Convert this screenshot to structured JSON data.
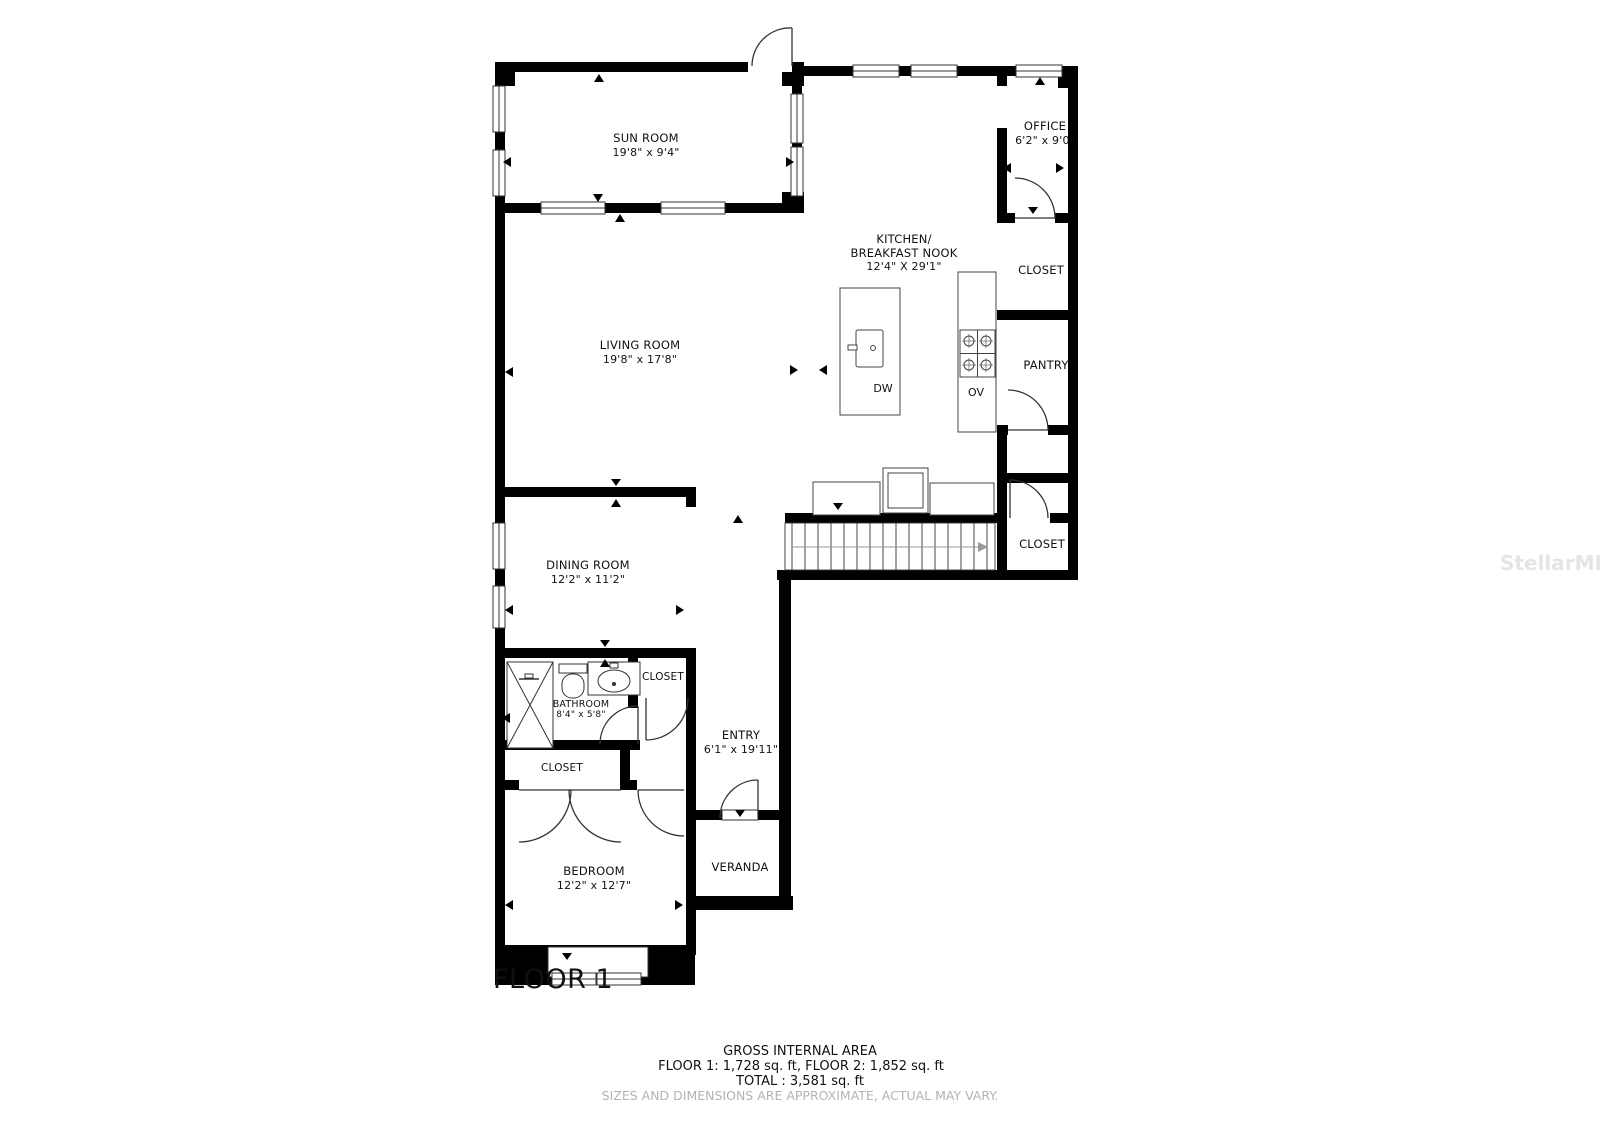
{
  "floorplan": {
    "floor_label": "FLOOR 1",
    "rooms": {
      "sun_room": {
        "name": "SUN ROOM",
        "dims": "19'8\" x 9'4\""
      },
      "office": {
        "name": "OFFICE",
        "dims": "6'2\" x 9'0\""
      },
      "kitchen": {
        "name_line1": "KITCHEN/",
        "name_line2": "BREAKFAST NOOK",
        "dims": "12'4\" X 29'1\""
      },
      "closet_top": {
        "name": "CLOSET"
      },
      "pantry": {
        "name": "PANTRY"
      },
      "living_room": {
        "name": "LIVING ROOM",
        "dims": "19'8\" x 17'8\""
      },
      "closet_stairs": {
        "name": "CLOSET"
      },
      "dining_room": {
        "name": "DINING ROOM",
        "dims": "12'2\" x 11'2\""
      },
      "bathroom": {
        "name": "BATHROOM",
        "dims": "8'4\" x 5'8\""
      },
      "closet_hall": {
        "name": "CLOSET"
      },
      "closet_bedroom": {
        "name": "CLOSET"
      },
      "entry": {
        "name": "ENTRY",
        "dims": "6'1\" x 19'11\""
      },
      "bedroom": {
        "name": "BEDROOM",
        "dims": "12'2\" x 12'7\""
      },
      "veranda": {
        "name": "VERANDA"
      }
    },
    "appliances": {
      "dishwasher": "DW",
      "oven": "OV"
    },
    "footer": {
      "area_title": "GROSS INTERNAL AREA",
      "area_line": "FLOOR 1: 1,728 sq. ft, FLOOR 2: 1,852 sq. ft",
      "total_line": "TOTAL :  3,581 sq. ft",
      "disclaimer": "SIZES AND DIMENSIONS ARE APPROXIMATE, ACTUAL MAY VARY."
    },
    "watermark": "StellarMLS",
    "colors": {
      "wall": "#000000",
      "line": "#333333",
      "disclaimer_gray": "#b3b3b3",
      "watermark_gray": "#e5e5e5"
    }
  }
}
